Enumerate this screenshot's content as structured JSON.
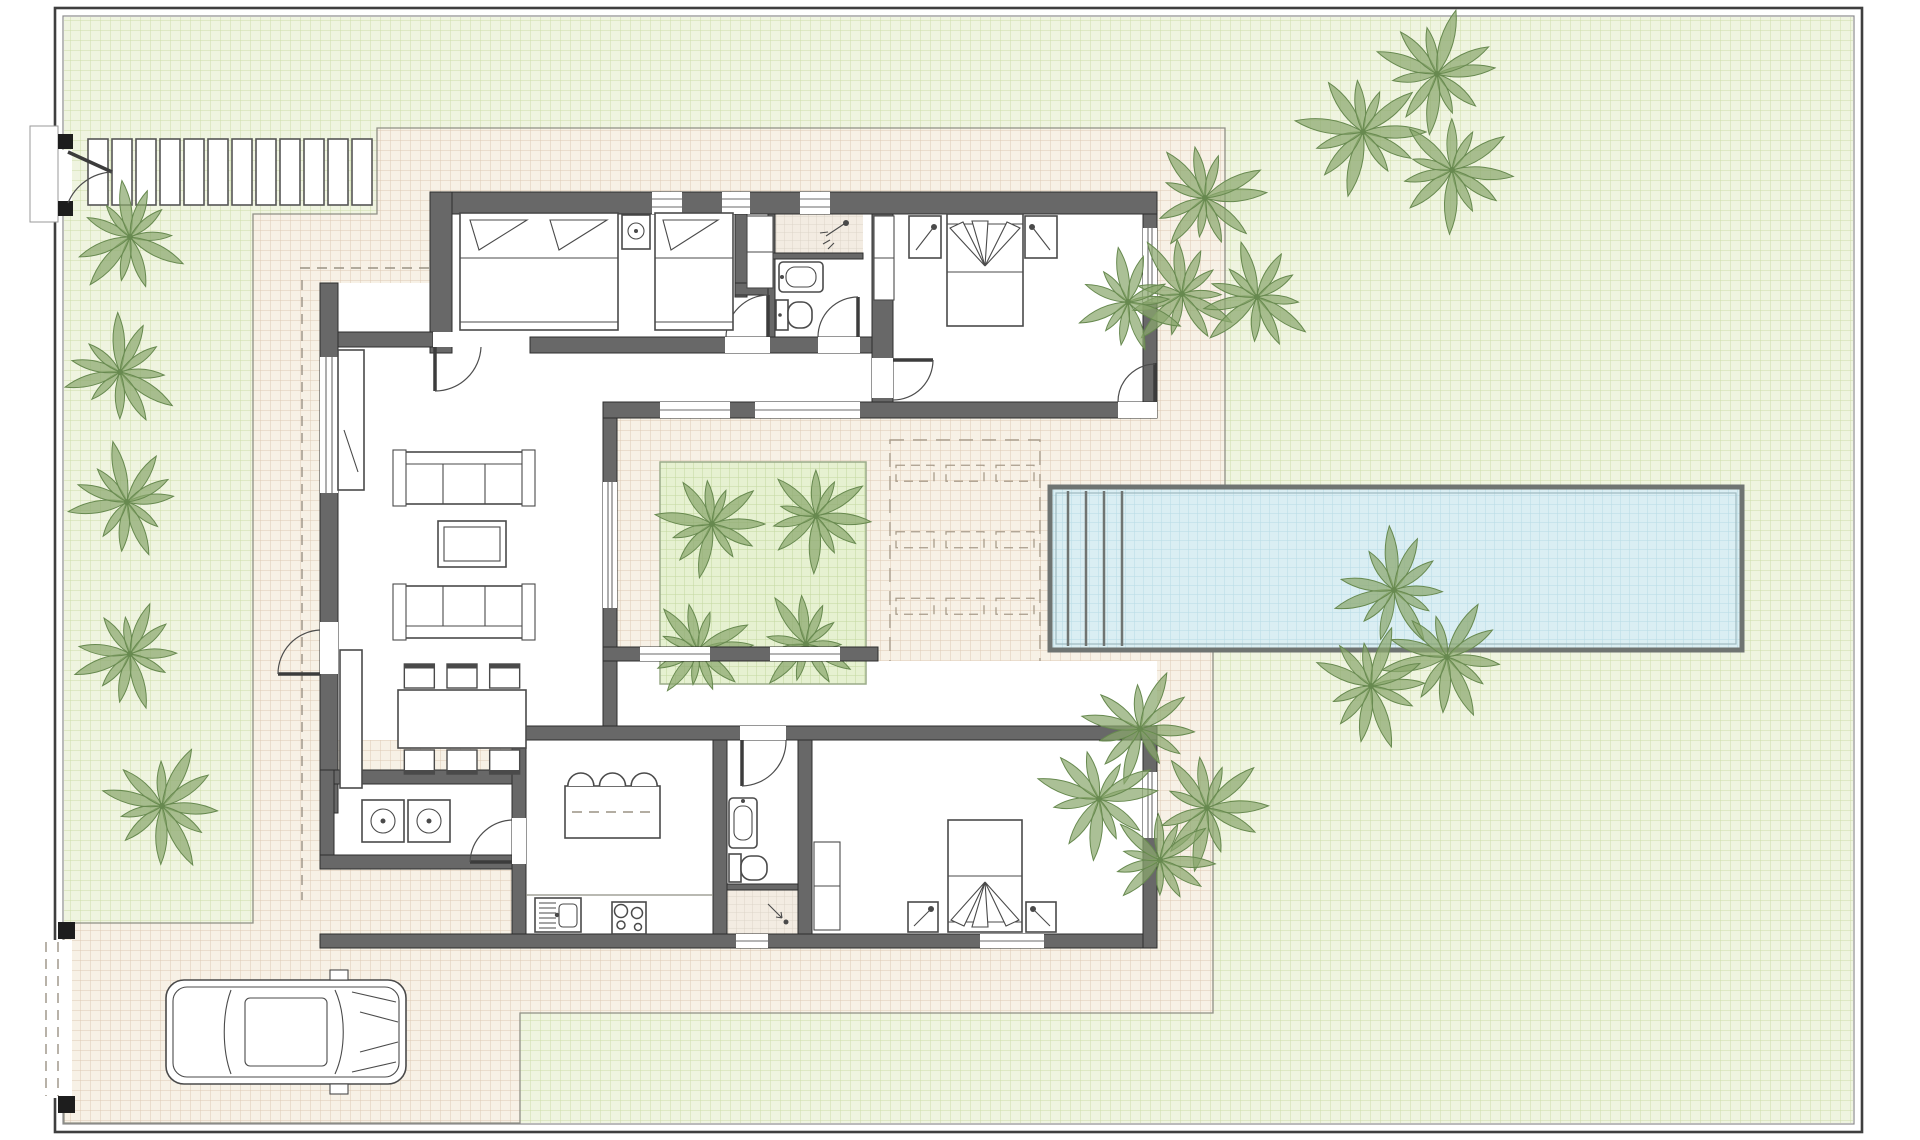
{
  "document": {
    "type": "architectural-floor-plan",
    "subject": "single-storey villa plot with garden, swimming pool, inner courtyard, terrace and driveway",
    "visible_text": "none"
  },
  "colors": {
    "page": "#ffffff",
    "lawn": "#eff4e0",
    "lawn_grid": "#ccdca8",
    "terrace": "#f7f1e6",
    "terrace_grid": "#dcc9b4",
    "pool_water": "#daeef3",
    "pool_grid": "#b7dbe4",
    "pool_edge": "#6f7472",
    "planting_bed": "#e6f1d1",
    "planting_grid": "#c3d79e",
    "tile": "#f3ece2",
    "tile_grid": "#d8cfc2",
    "wall": "#686868",
    "wall_dark": "#2e2e2e",
    "furniture": "#4a4a4a",
    "palm": "#8aa86d",
    "palm_dark": "#67894f",
    "line": "#8f8f85",
    "border_dark": "#3f3f3f",
    "border_light": "#8b8b8b"
  },
  "site": {
    "border_outer": [
      55,
      8,
      1807,
      1124
    ],
    "border_inner": [
      63,
      16,
      1791,
      1108
    ]
  },
  "walkway": {
    "stone_count": 12,
    "x0": 88,
    "pitch": 24,
    "stone_w": 20,
    "y": 139,
    "stone_h": 66
  },
  "gates": {
    "pedestrian": {
      "post_count": 2,
      "posts": [
        [
          62,
          134
        ],
        [
          62,
          201
        ]
      ],
      "opening": [
        46,
        150,
        26,
        54
      ]
    },
    "driveway": {
      "post_count": 2,
      "posts": [
        [
          58,
          922
        ],
        [
          58,
          1096
        ]
      ],
      "opening": [
        46,
        940,
        26,
        158
      ],
      "style": "dashed-sliding"
    }
  },
  "pool": {
    "x": 1050,
    "y": 487,
    "width": 692,
    "height": 163,
    "step_lines": 4,
    "step_pitch": 18
  },
  "sun_lounge_zone": {
    "x": 890,
    "y": 440,
    "width": 150,
    "height": 266,
    "cols": 3,
    "rows": 4
  },
  "courtyard": {
    "floor": [
      617,
      418,
      261,
      229
    ],
    "planting_bed": [
      660,
      462,
      206,
      222
    ],
    "palms": [
      [
        712,
        524,
        52
      ],
      [
        816,
        516,
        52
      ],
      [
        698,
        650,
        50
      ],
      [
        806,
        644,
        50
      ]
    ]
  },
  "garden_palms": [
    [
      130,
      237,
      56
    ],
    [
      120,
      372,
      56
    ],
    [
      127,
      502,
      56
    ],
    [
      130,
      654,
      53
    ],
    [
      162,
      806,
      60
    ],
    [
      1437,
      74,
      60
    ],
    [
      1363,
      132,
      62
    ],
    [
      1452,
      170,
      58
    ],
    [
      1205,
      198,
      56
    ],
    [
      1182,
      294,
      56
    ],
    [
      1257,
      297,
      56
    ],
    [
      1128,
      302,
      52
    ],
    [
      1394,
      590,
      58
    ],
    [
      1447,
      657,
      60
    ],
    [
      1371,
      686,
      58
    ],
    [
      1140,
      729,
      56
    ],
    [
      1099,
      799,
      58
    ],
    [
      1207,
      808,
      58
    ],
    [
      1160,
      860,
      50
    ]
  ],
  "dining": {
    "table": [
      398,
      690,
      128,
      58
    ],
    "chairs_top": 3,
    "chairs_bottom": 3
  },
  "kitchen": {
    "island": [
      565,
      786,
      95,
      52
    ],
    "island_stools": 3,
    "hob_burners": 4
  },
  "rooms": [
    "living-room",
    "dining-area",
    "kitchen",
    "utility-room",
    "bedroom-northwest",
    "bathroom-north",
    "bedroom-northeast",
    "bathroom-south",
    "bedroom-southeast",
    "inner-courtyard",
    "entry-hall"
  ],
  "fixtures": [
    "double-bed",
    "single-bed",
    "twin-nightstands",
    "table-lamp",
    "toilet",
    "washbasin",
    "shower",
    "sofa",
    "coffee-table",
    "tv-unit",
    "sideboard",
    "dining-table",
    "kitchen-island",
    "bar-stool",
    "sink",
    "hob",
    "washer",
    "dryer",
    "wardrobe",
    "car",
    "sun-lounger"
  ],
  "vehicles": {
    "car_count": 1
  }
}
